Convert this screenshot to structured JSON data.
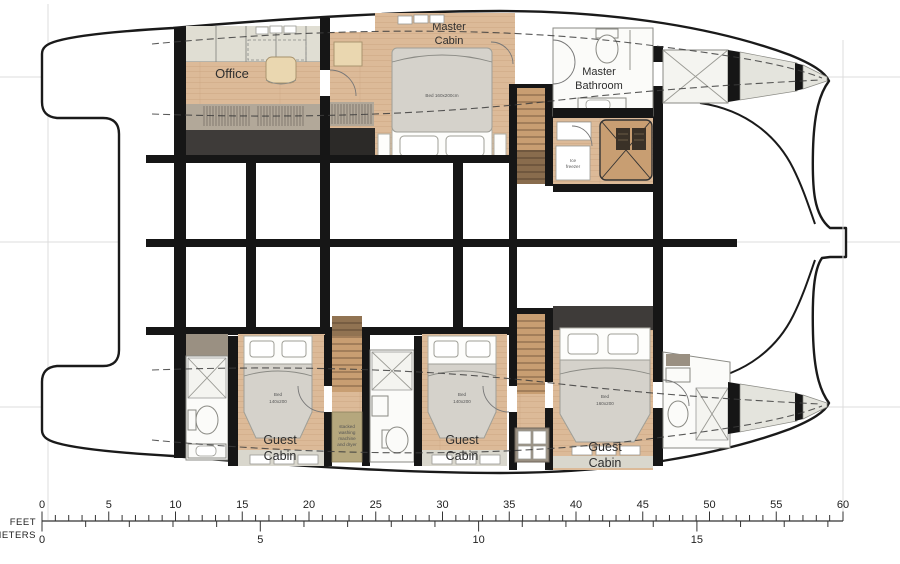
{
  "rooms": {
    "office": {
      "label": "Office"
    },
    "master_cabin": {
      "line1": "Master",
      "line2": "Cabin",
      "bed_label": "Bed 160x200cm"
    },
    "master_bathroom": {
      "line1": "Master",
      "line2": "Bathroom"
    },
    "ice_freezer": {
      "line1": "Ice",
      "line2": "freezer"
    },
    "laundry": {
      "line1": "stacked",
      "line2": "washing",
      "line3": "machine",
      "line4": "and dryer"
    },
    "guest_cabin": {
      "line1": "Guest",
      "line2": "Cabin"
    },
    "guest_bed_small": {
      "line1": "Bed",
      "line2": "140x200"
    },
    "guest_bed_vip": {
      "line1": "Bed",
      "line2": "160x200"
    }
  },
  "scale": {
    "feet": {
      "label": "FEET",
      "max": 60,
      "labeled": [
        0,
        5,
        10,
        15,
        20,
        25,
        30,
        35,
        40,
        45,
        50,
        55,
        60
      ]
    },
    "meters": {
      "label": "METERS",
      "max": 18,
      "labeled": [
        0,
        5,
        10,
        15
      ]
    }
  },
  "colors": {
    "hull_outline": "#1a1a1a",
    "structure_black": "#161616",
    "wood_floor": "#dcba98",
    "cabinet_beige": "#e0ded3",
    "wardrobe_taupe": "#b2a899",
    "dark_gray_band": "#3e3b39",
    "bathroom_white": "#fbfbf9",
    "mattress_gray": "#d5d2cb",
    "bow_pale": "#e4e4dd",
    "laundry_khaki": "#b5a77d"
  }
}
